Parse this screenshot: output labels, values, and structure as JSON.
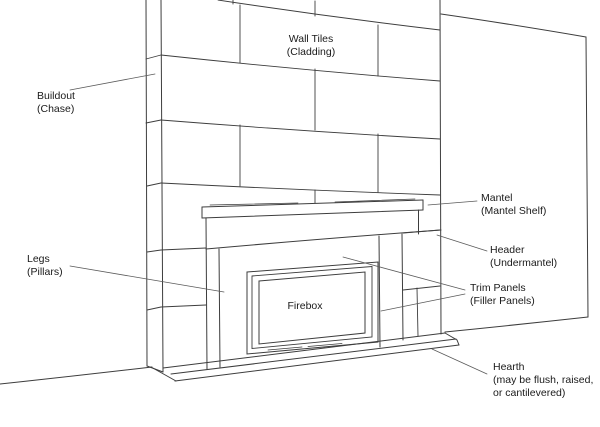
{
  "labels": {
    "wall_tiles": {
      "line1": "Wall Tiles",
      "line2": "(Cladding)"
    },
    "buildout": {
      "line1": "Buildout",
      "line2": "(Chase)"
    },
    "mantel": {
      "line1": "Mantel",
      "line2": "(Mantel Shelf)"
    },
    "header": {
      "line1": "Header",
      "line2": "(Undermantel)"
    },
    "legs": {
      "line1": "Legs",
      "line2": "(Pillars)"
    },
    "firebox": {
      "line1": "Firebox"
    },
    "trim_panels": {
      "line1": "Trim Panels",
      "line2": "(Filler Panels)"
    },
    "hearth": {
      "line1": "Hearth",
      "line2": "(may be flush, raised,",
      "line3": "or cantilevered)"
    }
  },
  "colors": {
    "line": "#3d3d3d",
    "leader_line": "#5a5a5a",
    "text": "#1a1a1a",
    "background": "#ffffff"
  }
}
